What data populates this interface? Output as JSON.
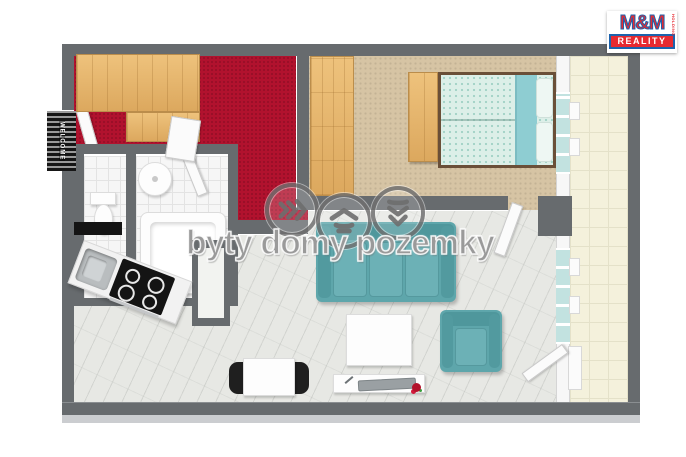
{
  "brand": {
    "name": "M&M",
    "holding": "HOLDING",
    "reality": "REALITY",
    "red": "#e62a31",
    "blue": "#1c63ad"
  },
  "watermark": {
    "text": "byty domy pozemky",
    "icons": [
      "chevrons-right-icon",
      "house-icon",
      "chevrons-down-icon"
    ],
    "color": "#9a9a9a"
  },
  "entrance": {
    "doormat_text": "WELCOME"
  },
  "colors": {
    "wall_gray": "#676b6e",
    "hallway_carpet_red": "#b1122e",
    "bedroom_carpet_tan": "#d6c4a4",
    "living_floor_marble": "#e7e8e4",
    "balcony_tile_cream": "#f4f1dc",
    "bathroom_tile_white": "#f6f6f6",
    "wood_furniture": "#e4b369",
    "upholstery_teal": "#5ea6ab",
    "bed_linen_mint": "#dcefe8",
    "bed_blanket_teal": "#8ecdd2",
    "cooktop_black": "#141414"
  },
  "rooms": {
    "hallway": {
      "floor": "red carpet",
      "furniture": [
        "wardrobe",
        "wardrobe-low",
        "entrance-door",
        "doormat"
      ]
    },
    "bedroom": {
      "floor": "tan carpet",
      "furniture": [
        "tall-wardrobe",
        "bedside-cabinet",
        "double-bed",
        "window"
      ]
    },
    "wc": {
      "floor": "white tile",
      "furniture": [
        "toilet"
      ]
    },
    "bathroom": {
      "floor": "white tile",
      "furniture": [
        "round-sink",
        "bathtub"
      ]
    },
    "living_room": {
      "floor": "marble",
      "furniture": [
        "kitchen-sink",
        "cooktop",
        "sofa",
        "coffee-table",
        "armchair",
        "dining-table",
        "dining-chairs",
        "desk-with-tv",
        "flowers",
        "balcony-door"
      ]
    },
    "balcony": {
      "floor": "cream tile",
      "furniture": []
    }
  }
}
